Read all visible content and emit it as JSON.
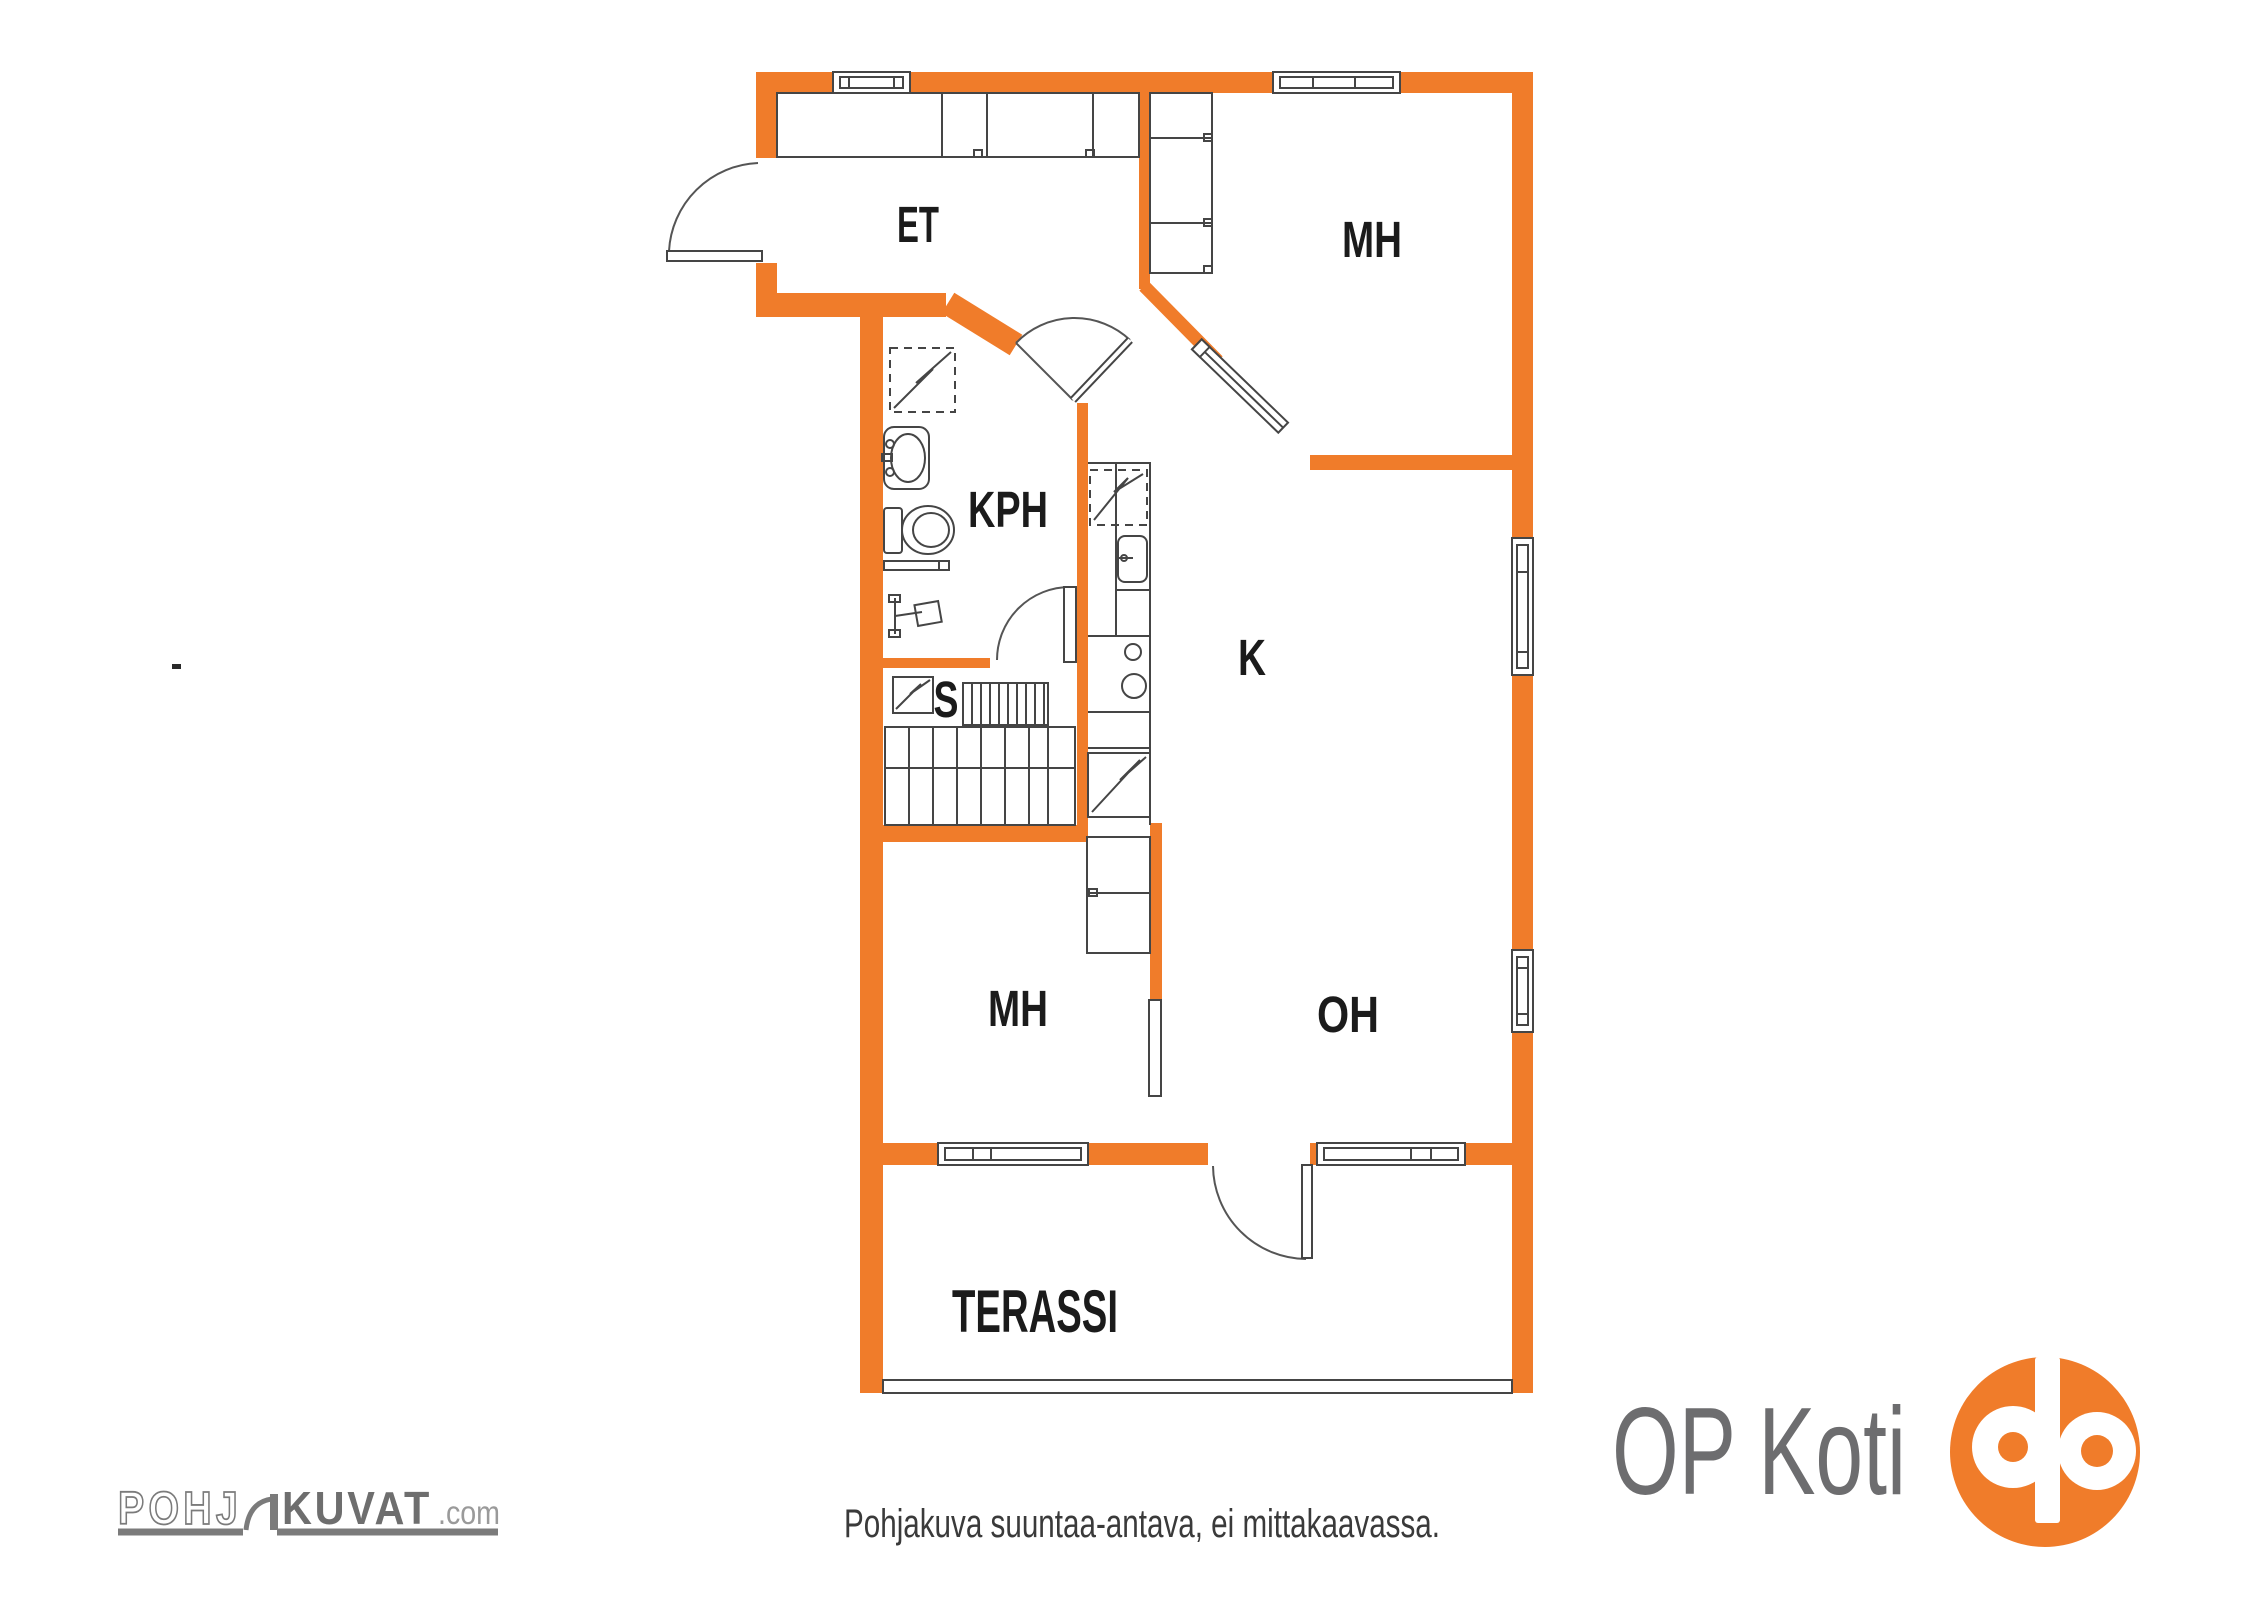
{
  "rooms": {
    "entry": "ET",
    "bedroom_top": "MH",
    "bathroom": "KPH",
    "kitchen": "K",
    "sauna": "S",
    "bedroom_bottom": "MH",
    "living_room": "OH",
    "terrace": "TERASSI"
  },
  "watermark": {
    "outline_part": "POHJ",
    "solid_part": "KUVAT",
    "domain_suffix": ".com"
  },
  "footer": {
    "brand_text": "OP Koti",
    "disclaimer": "Pohjakuva suuntaa-antava, ei mittakaavassa."
  },
  "colors": {
    "wall_orange": "#F07C2A",
    "op_logo_orange": "#F07C2A",
    "logo_gray": "#6D6D6F",
    "line_dark": "#454545",
    "label_black": "#1B1B1B",
    "disclaimer_gray": "#3A3A3A"
  },
  "fixtures": {
    "washing_machine": "dashed-zigzag-square",
    "dishwasher": "dashed-zigzag-square",
    "fridge": "zigzag-square",
    "sauna_stove": "zigzag-square",
    "bathroom_sink": "oval-basin",
    "toilet": "wc-bowl",
    "shower": "mixer-cross",
    "stove": "two-burners",
    "stairs": "treads"
  }
}
